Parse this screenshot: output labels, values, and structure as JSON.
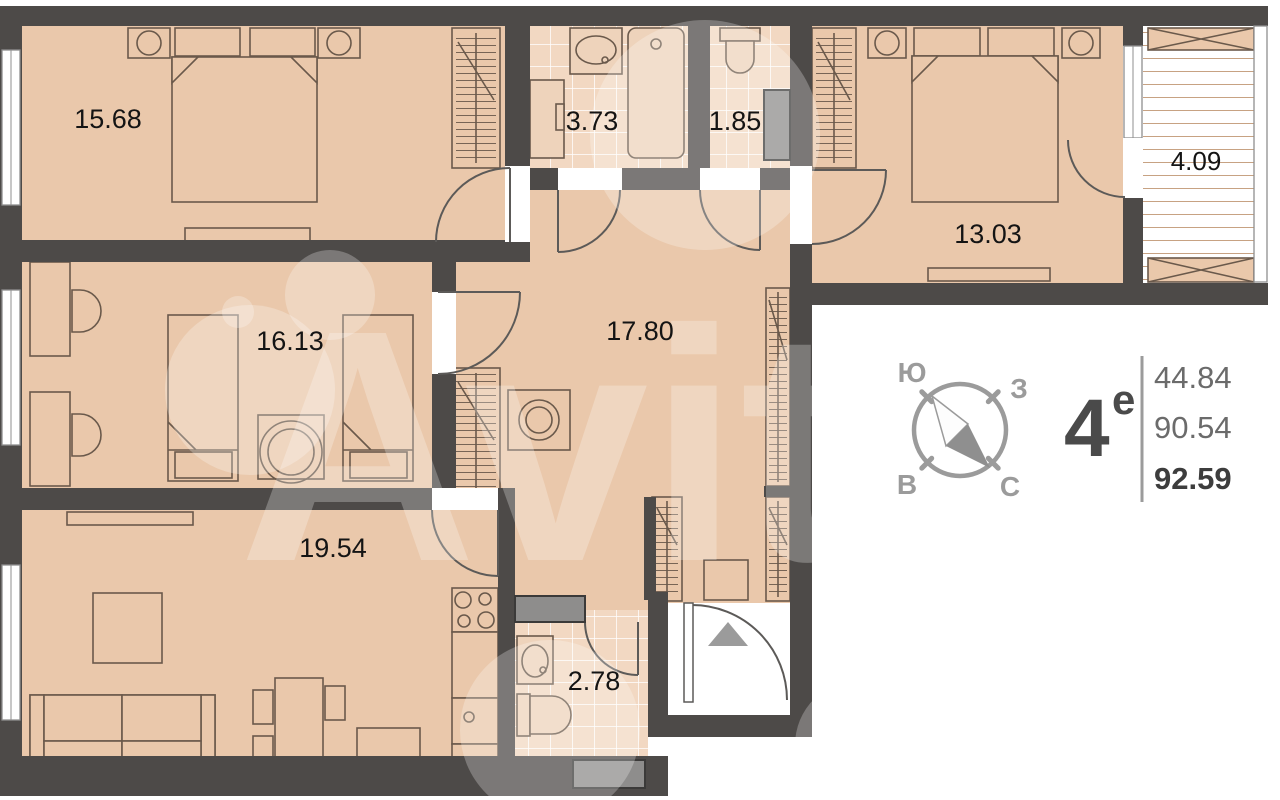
{
  "floorplan": {
    "watermark": "Avito",
    "rooms": [
      {
        "name": "bedroom-1",
        "area": "15.68"
      },
      {
        "name": "bathroom-1",
        "area": "3.73"
      },
      {
        "name": "wc",
        "area": "1.85"
      },
      {
        "name": "bedroom-2",
        "area": "13.03"
      },
      {
        "name": "balcony",
        "area": "4.09"
      },
      {
        "name": "kids-room",
        "area": "16.13"
      },
      {
        "name": "hallway",
        "area": "17.80"
      },
      {
        "name": "living-kitchen",
        "area": "19.54"
      },
      {
        "name": "bathroom-2",
        "area": "2.78"
      }
    ],
    "compass": {
      "top_left": "Ю",
      "top_right": "З",
      "bottom_left": "В",
      "bottom_right": "С"
    },
    "apartment": {
      "type_number": "4",
      "type_letter": "е",
      "living_area": "44.84",
      "floor_area": "90.54",
      "total_area": "92.59"
    },
    "colors": {
      "wall": "#4d4a48",
      "floor": "#eac8ab",
      "tile": "#f2d8c2",
      "shaft_gray": "#8e8d8c",
      "marker_gray": "#9b9b9b"
    }
  }
}
